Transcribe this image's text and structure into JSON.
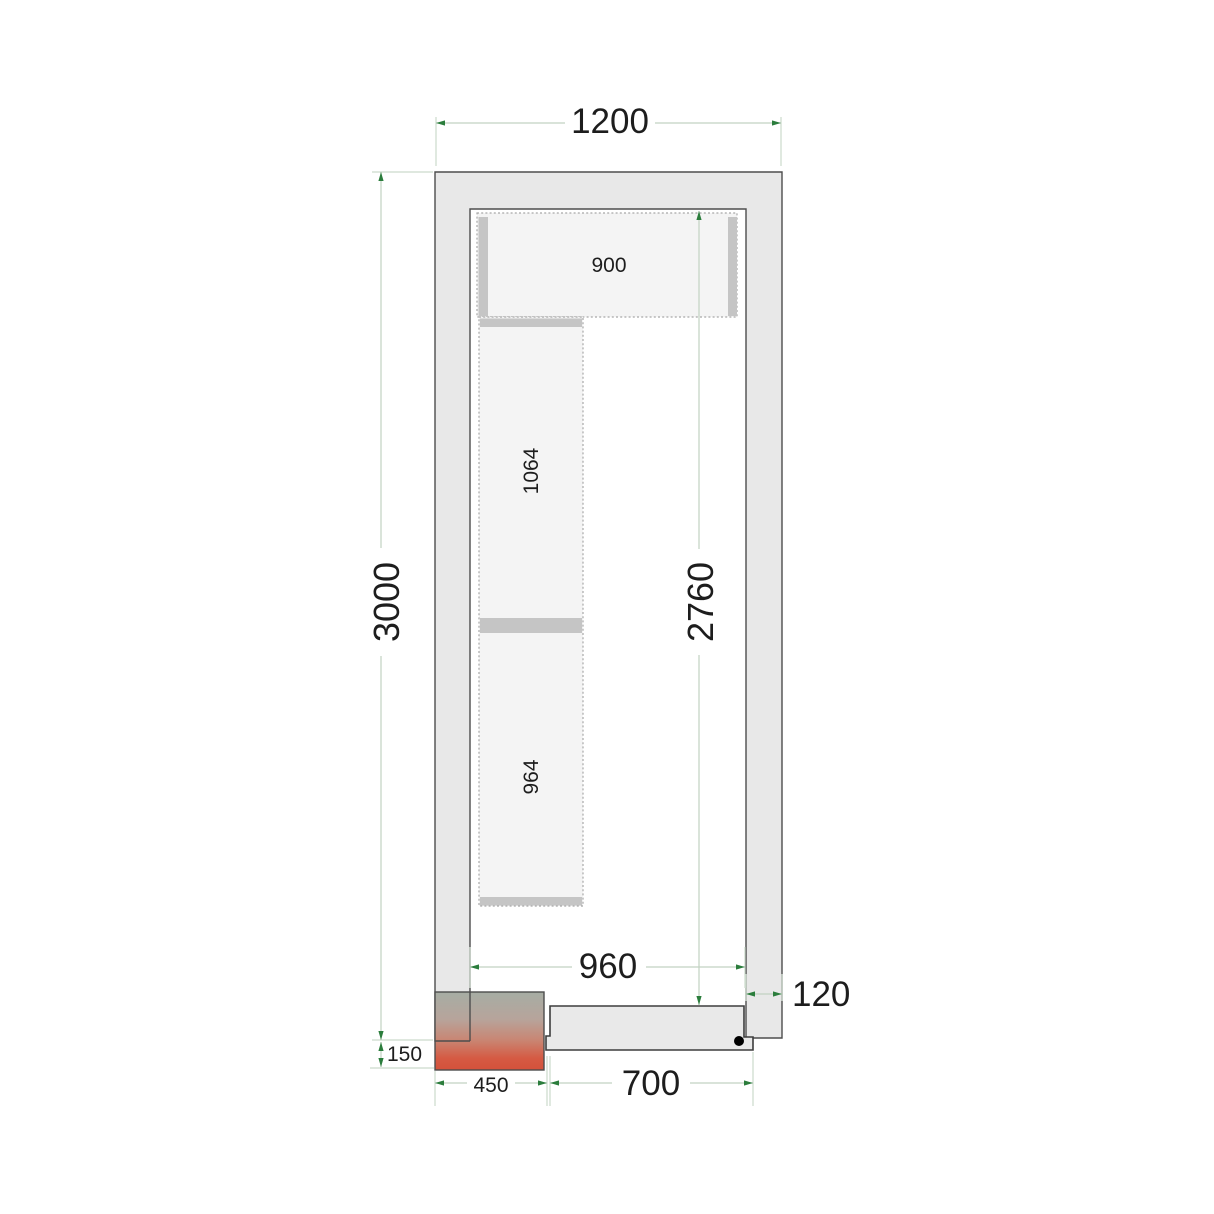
{
  "dimensions": {
    "outer_width": "1200",
    "outer_length": "3000",
    "inner_length": "2760",
    "inner_width": "960",
    "wall_thickness": "120",
    "unit_depth": "150",
    "unit_width": "450",
    "door_width": "700"
  },
  "shelving": {
    "top_shelf": "900",
    "side_shelf_upper": "1064",
    "side_shelf_lower": "964"
  },
  "colors": {
    "wall_fill": "#e8e8e8",
    "wall_outline": "#4d4d4d",
    "door_fill": "#e9e9e9",
    "shelf_fill": "#f4f4f4",
    "shelf_dash": "#a8a8a8",
    "support_bar": "#c5c5c5",
    "dim_line": "#c2d2c2",
    "dim_arrow_green": "#2b7d3c",
    "label_text": "#1d1d1d",
    "unit_gradient_top": "#a6ada4",
    "unit_gradient_bottom": "#d4513b",
    "door_handle": "#000000"
  }
}
